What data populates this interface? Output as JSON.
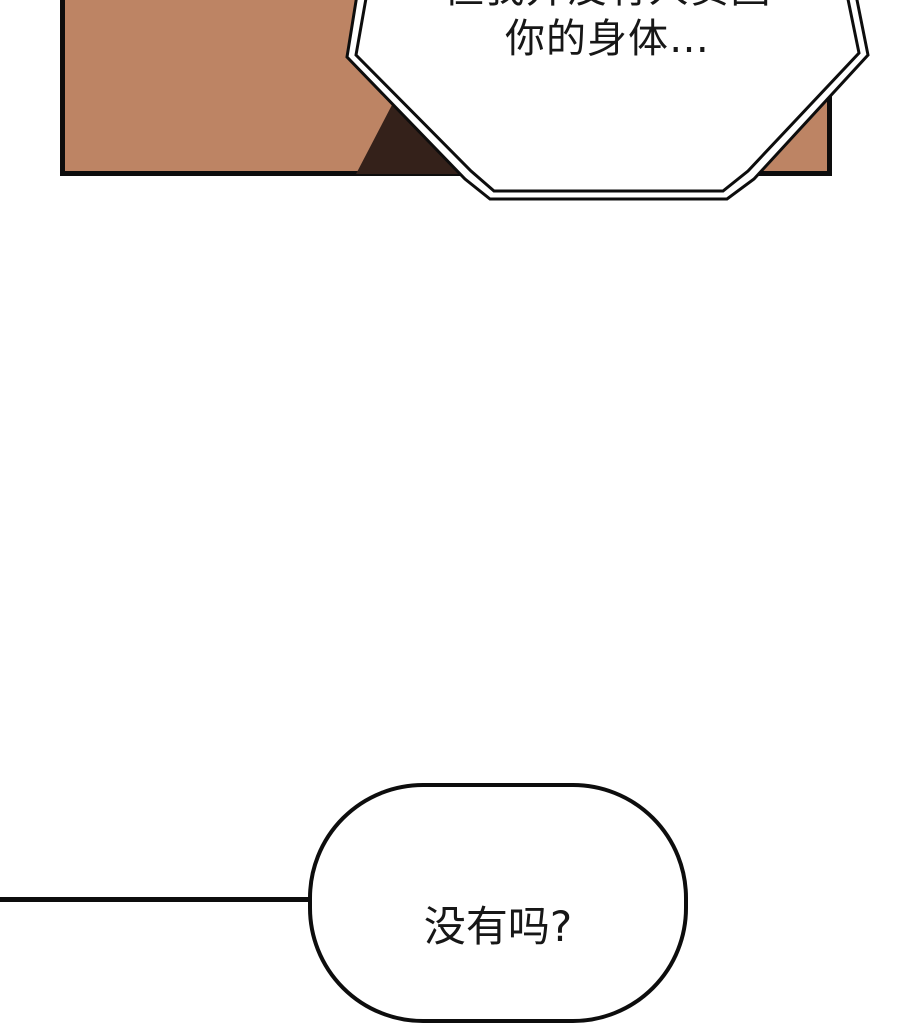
{
  "page": {
    "background_color": "#ffffff",
    "ink_color": "#0d0d0d"
  },
  "panel": {
    "fill_color": "#bd8464",
    "silhouette_color": "#34211a"
  },
  "speech": {
    "octagon_bubble": {
      "line1": "但我并没有人贪图",
      "line2": "你的身体…",
      "fill_color": "#ffffff"
    },
    "rounded_bubble": {
      "text": "没有吗?",
      "fill_color": "#ffffff"
    }
  }
}
